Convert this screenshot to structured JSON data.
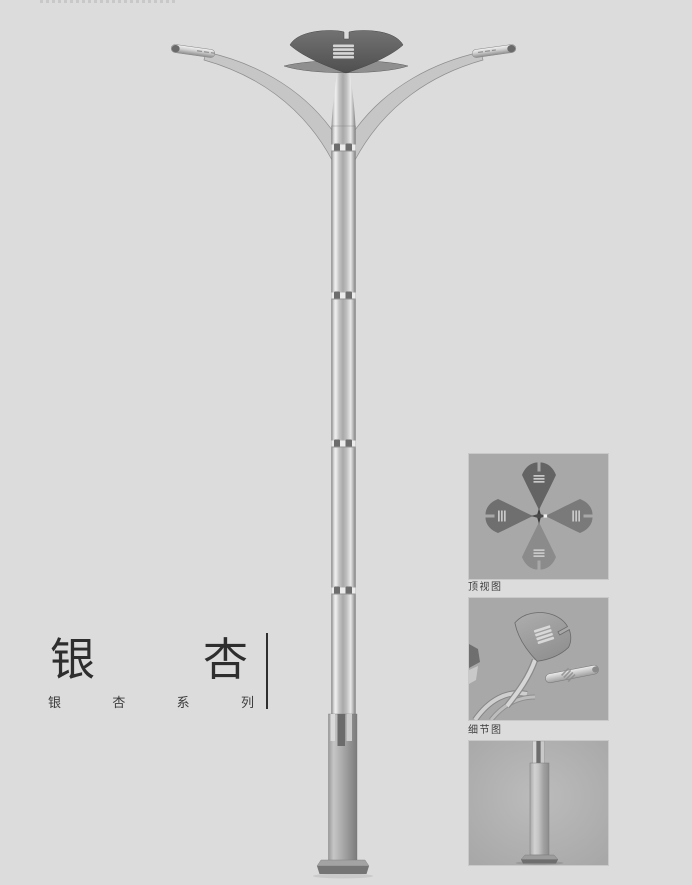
{
  "page": {
    "background": "#dcdcdc",
    "cropped_top_text": ""
  },
  "title": {
    "full": "银杏",
    "chars": [
      "银",
      "杏"
    ]
  },
  "subtitle": {
    "full": "银杏系列",
    "chars": [
      "银",
      "杏",
      "系",
      "列"
    ]
  },
  "insets": [
    {
      "label": "顶视图"
    },
    {
      "label": "细节图"
    },
    {
      "label": ""
    }
  ],
  "colors": {
    "page_bg": "#dcdcdc",
    "panel_bg": "#a8a8a8",
    "panel_border": "#c9c9c9",
    "title_text": "#2e2e2e",
    "caption_text": "#3d3d3d",
    "lamp_head_dark": "#5c5c5c",
    "pole_highlight": "#ececec",
    "pole_mid": "#a9a9a9",
    "base_column": "#9b9b9b"
  }
}
